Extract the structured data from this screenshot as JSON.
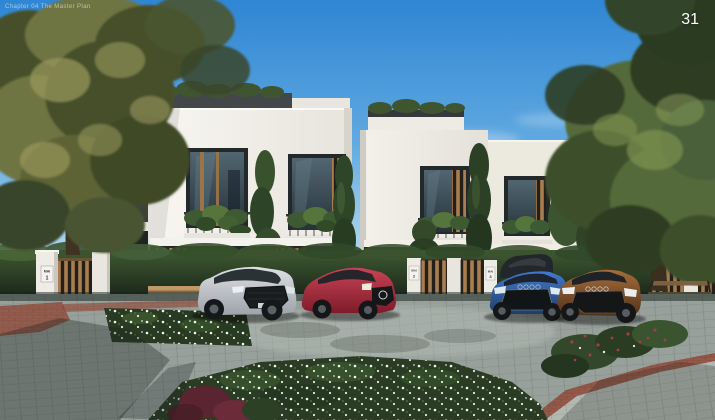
{
  "meta": {
    "watermark": "Chapter 04 The Master Plan",
    "page_number": "31"
  },
  "signs": {
    "unit1": {
      "name": "MAI",
      "number": "1"
    },
    "unit2": {
      "name": "MAI",
      "number": "2"
    },
    "unit3": {
      "name": "MAI",
      "number": "3"
    }
  },
  "scene": {
    "description": "Photorealistic architectural rendering of a row of modern white two-storey townhouses with wood-slat accents, planted balconies and rooftop greenery; four cars parked along a paver street with hedges, white gate pillars, wooden gates, benches and flower beds, framed by large trees under a blue sky.",
    "palette": {
      "sky_top": "#2f86d3",
      "sky_horizon": "#d3e9f6",
      "facade_white": "#f6f4ef",
      "facade_shade": "#ddd9d1",
      "roof_band": "#3a3e40",
      "wood_slat": "#a87e50",
      "window_glass": "#2b3940",
      "hedge_green": "#31462a",
      "tree_left_olive": "#7d7f4a",
      "tree_right_green": "#556b3a",
      "road_paver": "#97a09b",
      "brick_red": "#93503f",
      "flowerbed_green": "#283a22",
      "flower_white": "#f2f4ee"
    },
    "cars": [
      {
        "name": "silver-audi-sedan",
        "color": "#c9ccd1"
      },
      {
        "name": "red-mercedes-coupe",
        "color": "#b02a3a"
      },
      {
        "name": "dark-suv",
        "color": "#22272b"
      },
      {
        "name": "blue-audi-sedan",
        "color": "#2e62b6"
      },
      {
        "name": "brown-audi-sedan",
        "color": "#8a5428"
      }
    ]
  }
}
